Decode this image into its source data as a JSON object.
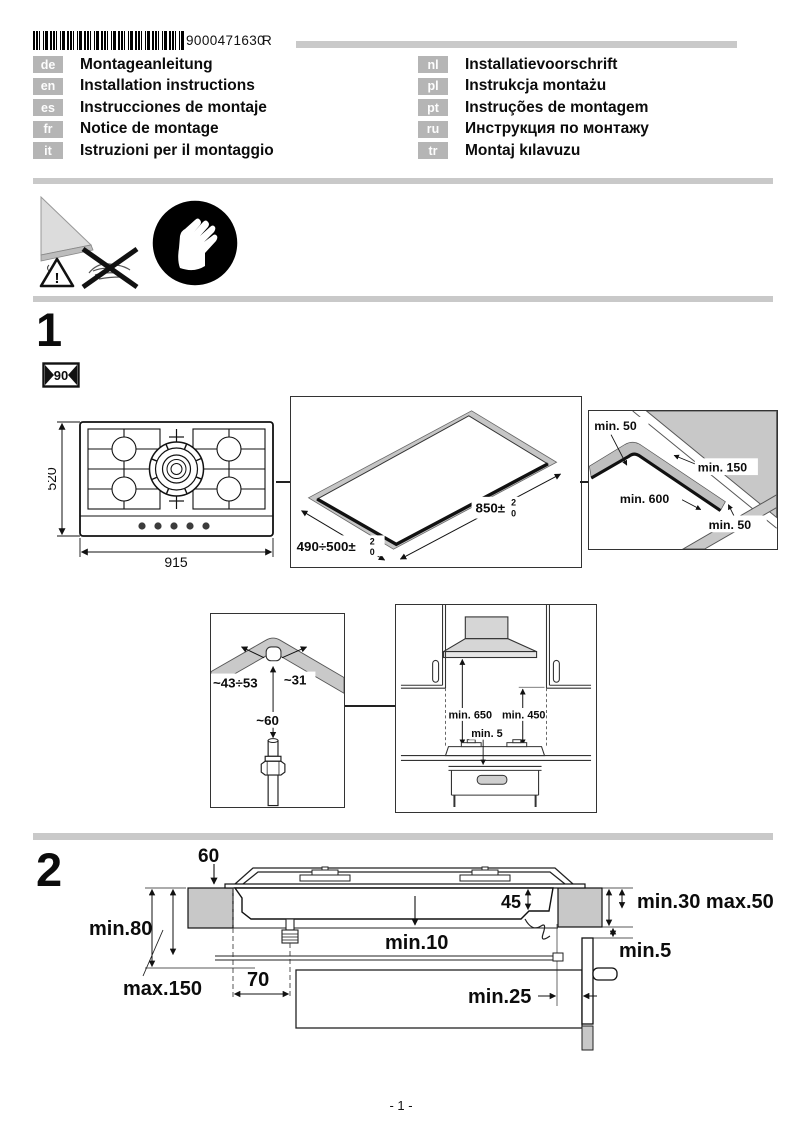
{
  "header": {
    "barcode_text": "9000471630",
    "revision": "R"
  },
  "languages": {
    "left": [
      {
        "code": "de",
        "title": "Montageanleitung"
      },
      {
        "code": "en",
        "title": "Installation instructions"
      },
      {
        "code": "es",
        "title": "Instrucciones de montaje"
      },
      {
        "code": "fr",
        "title": "Notice de montage"
      },
      {
        "code": "it",
        "title": "Istruzioni per il montaggio"
      }
    ],
    "right": [
      {
        "code": "nl",
        "title": "Installatievoorschrift"
      },
      {
        "code": "pl",
        "title": "Instrukcja montażu"
      },
      {
        "code": "pt",
        "title": "Instruções de montagem"
      },
      {
        "code": "ru",
        "title": "Инструкция по монтажу"
      },
      {
        "code": "tr",
        "title": "Montaj kılavuzu"
      }
    ]
  },
  "s1": {
    "number": "1",
    "badge": "90",
    "hob": {
      "depth": "520",
      "width": "915"
    },
    "cutout": {
      "width": "490÷500±",
      "length": "850±",
      "tol_sup": "2",
      "tol_sub": "0"
    },
    "corner": {
      "top": "min. 50",
      "right": "min. 150",
      "center": "min. 600",
      "bottom": "min. 50"
    },
    "gas": {
      "left": "~43÷53",
      "right": "~31",
      "down": "~60"
    },
    "hood": {
      "left": "min. 650",
      "right": "min. 450",
      "gap": "min. 5"
    }
  },
  "s2": {
    "number": "2",
    "top": "60",
    "r45": "45",
    "left": "min.80",
    "right": "min.30 max.50",
    "mid": "min.10",
    "maxdepth": "max.150",
    "d70": "70",
    "min25": "min.25",
    "min5": "min.5"
  },
  "footer": {
    "page": "- 1 -"
  }
}
